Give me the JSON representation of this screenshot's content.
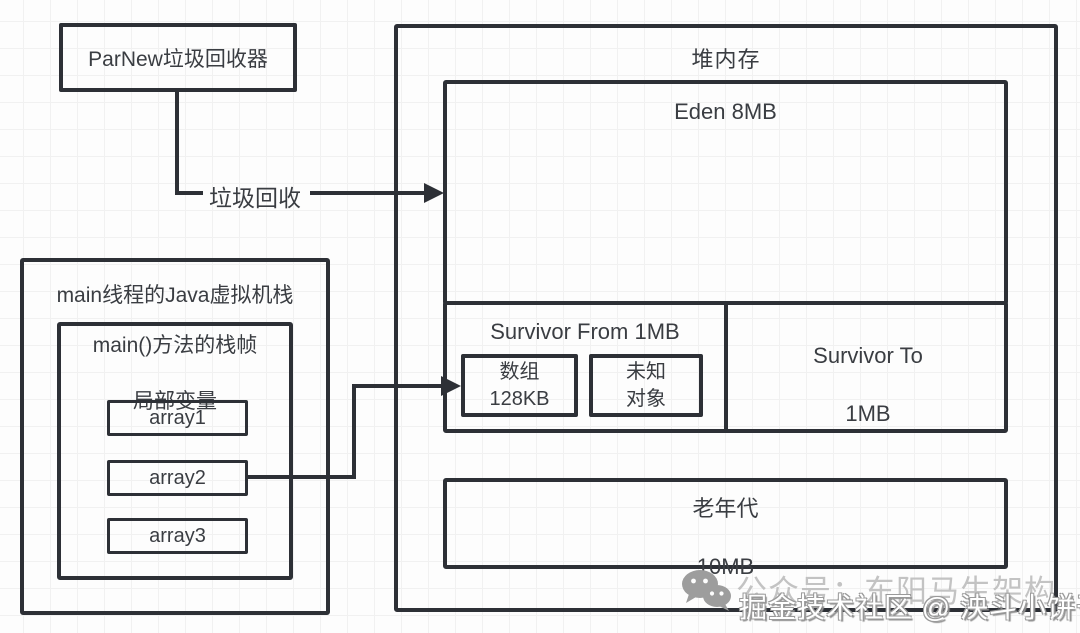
{
  "parnew": {
    "label": "ParNew垃圾回收器"
  },
  "gc_arrow": {
    "label": "垃圾回收"
  },
  "stack": {
    "title": "main线程的Java虚拟机栈",
    "frame": {
      "title_line1": "main()方法的栈帧",
      "title_line2": "局部变量",
      "vars": [
        "array1",
        "array2",
        "array3"
      ]
    }
  },
  "heap": {
    "title": "堆内存",
    "eden": {
      "label": "Eden 8MB"
    },
    "survivor_from": {
      "title": "Survivor From 1MB",
      "array_object": {
        "line1": "数组",
        "line2": "128KB"
      },
      "unknown_object": {
        "line1": "未知",
        "line2": "对象"
      }
    },
    "survivor_to": {
      "line1": "Survivor To",
      "line2": "1MB"
    },
    "old_gen": {
      "line1": "老年代",
      "line2": "10MB"
    }
  },
  "watermark": {
    "brand": "公众号：东阳马生架构",
    "credit": "掘金技术社区 @ 泱斗小饼干",
    "icon": "wechat-icon"
  },
  "colors": {
    "border": "#2d3036",
    "text": "#3a3d42",
    "watermark_gray": "#bdbdbd",
    "grid": "#f1f1f1",
    "background": "#fdfdfd"
  }
}
